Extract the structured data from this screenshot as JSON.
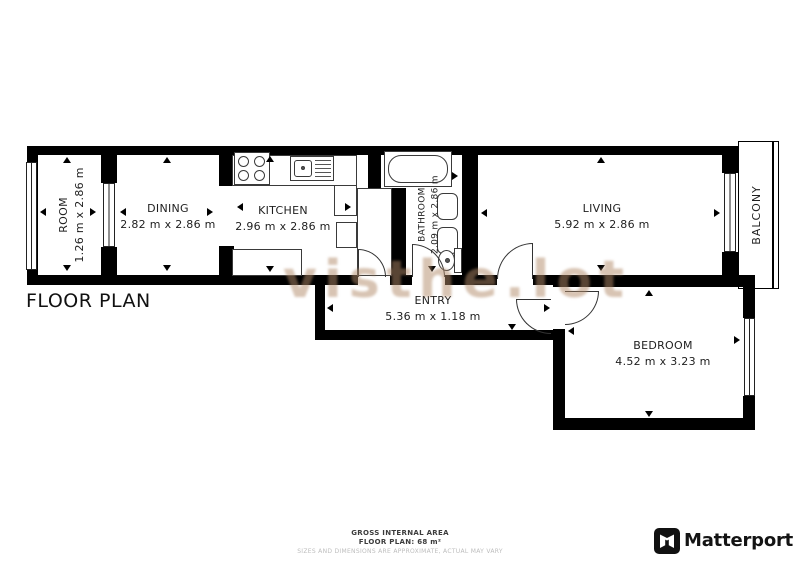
{
  "plan": {
    "title": "FLOOR PLAN",
    "watermark": "visthe.lot",
    "rooms": [
      {
        "id": "room",
        "name": "ROOM",
        "dims": "1.26 m x 2.86 m"
      },
      {
        "id": "dining",
        "name": "DINING",
        "dims": "2.82 m x 2.86 m"
      },
      {
        "id": "kitchen",
        "name": "KITCHEN",
        "dims": "2.96 m x 2.86 m"
      },
      {
        "id": "bathroom",
        "name": "BATHROOM",
        "dims": "2.09 m x 2.86 m"
      },
      {
        "id": "living",
        "name": "LIVING",
        "dims": "5.92 m x 2.86 m"
      },
      {
        "id": "balcony",
        "name": "BALCONY",
        "dims": ""
      },
      {
        "id": "entry",
        "name": "ENTRY",
        "dims": "5.36 m x 1.18 m"
      },
      {
        "id": "bedroom",
        "name": "BEDROOM",
        "dims": "4.52 m x 3.23 m"
      }
    ],
    "colors": {
      "wall": "#000000",
      "label": "#1e1e1e",
      "watermark": "#b28a68"
    }
  },
  "footer": {
    "gross_area_label": "GROSS INTERNAL AREA",
    "floor_plan_area": "FLOOR PLAN: 68 m²",
    "disclaimer": "SIZES AND DIMENSIONS ARE APPROXIMATE, ACTUAL MAY VARY",
    "brand": "Matterport"
  }
}
